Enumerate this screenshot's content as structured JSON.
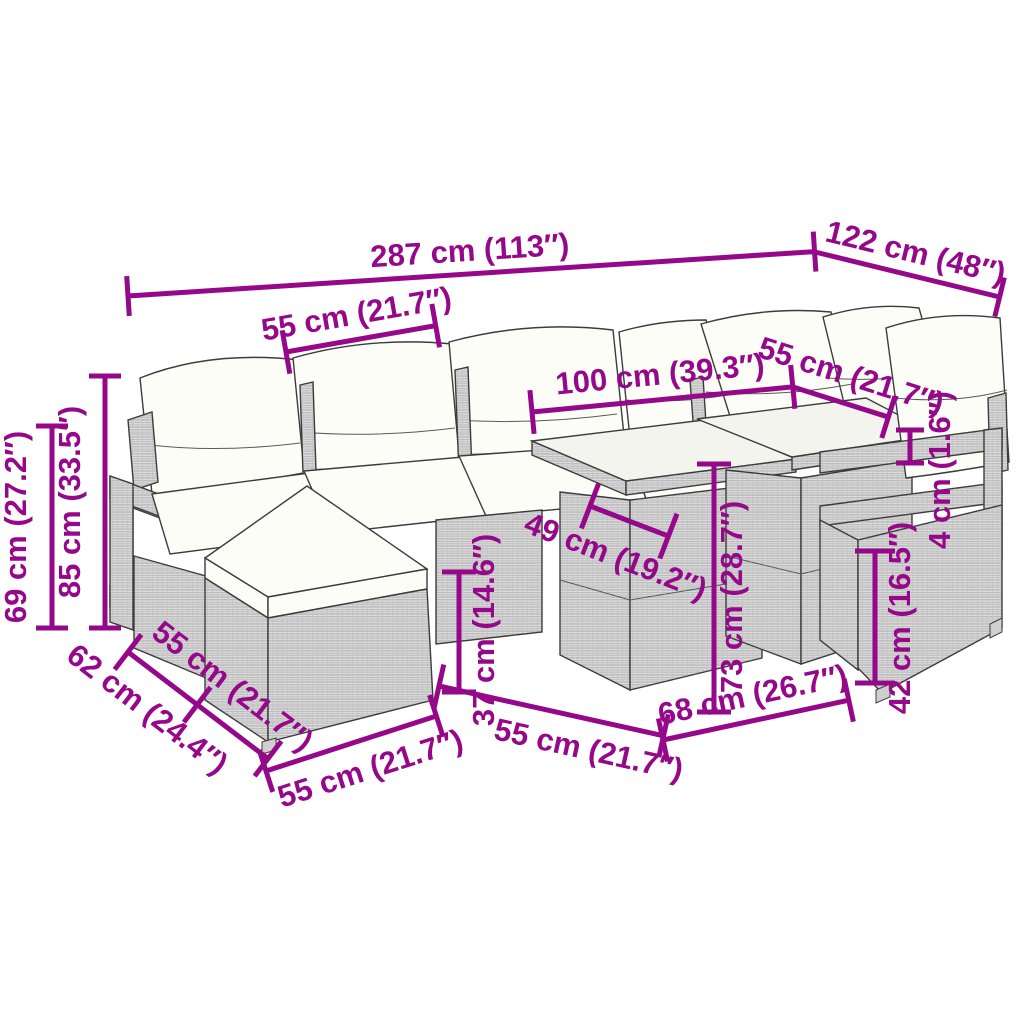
{
  "diagram_title": "Garden furniture set dimension diagram",
  "colors": {
    "accent": "#95088A",
    "outline": "#3c3c3c",
    "rattan_fill": "#e4e4e4",
    "rattan_line": "#a8a8a8",
    "cushion": "#fdfdf8",
    "glass_top": "#f4f4ee",
    "background": "#ffffff"
  },
  "illustration": {
    "description": "L-shaped poly rattan garden lounge set with back pillows, seat cushions, footstool, two cube tables with glass tops and an armchair"
  },
  "dims": [
    {
      "label": "287 cm (113″)"
    },
    {
      "label": "122 cm (48″)"
    },
    {
      "label": "55 cm (21.7″)"
    },
    {
      "label": "100 cm (39.3″)"
    },
    {
      "label": "55 cm (21.7″)"
    },
    {
      "label": "4 cm (1.6″)"
    },
    {
      "label": "69 cm (27.2″)"
    },
    {
      "label": "85 cm (33.5″)"
    },
    {
      "label": "49 cm (19.2″)"
    },
    {
      "label": "73 cm (28.7″)"
    },
    {
      "label": "37 cm (14.6″)"
    },
    {
      "label": "62 cm (24.4″)"
    },
    {
      "label": "55 cm (21.7″)"
    },
    {
      "label": "55 cm (21.7″)"
    },
    {
      "label": "55 cm (21.7″)"
    },
    {
      "label": "68 cm (26.7″)"
    },
    {
      "label": "42 cm (16.5″)"
    }
  ]
}
